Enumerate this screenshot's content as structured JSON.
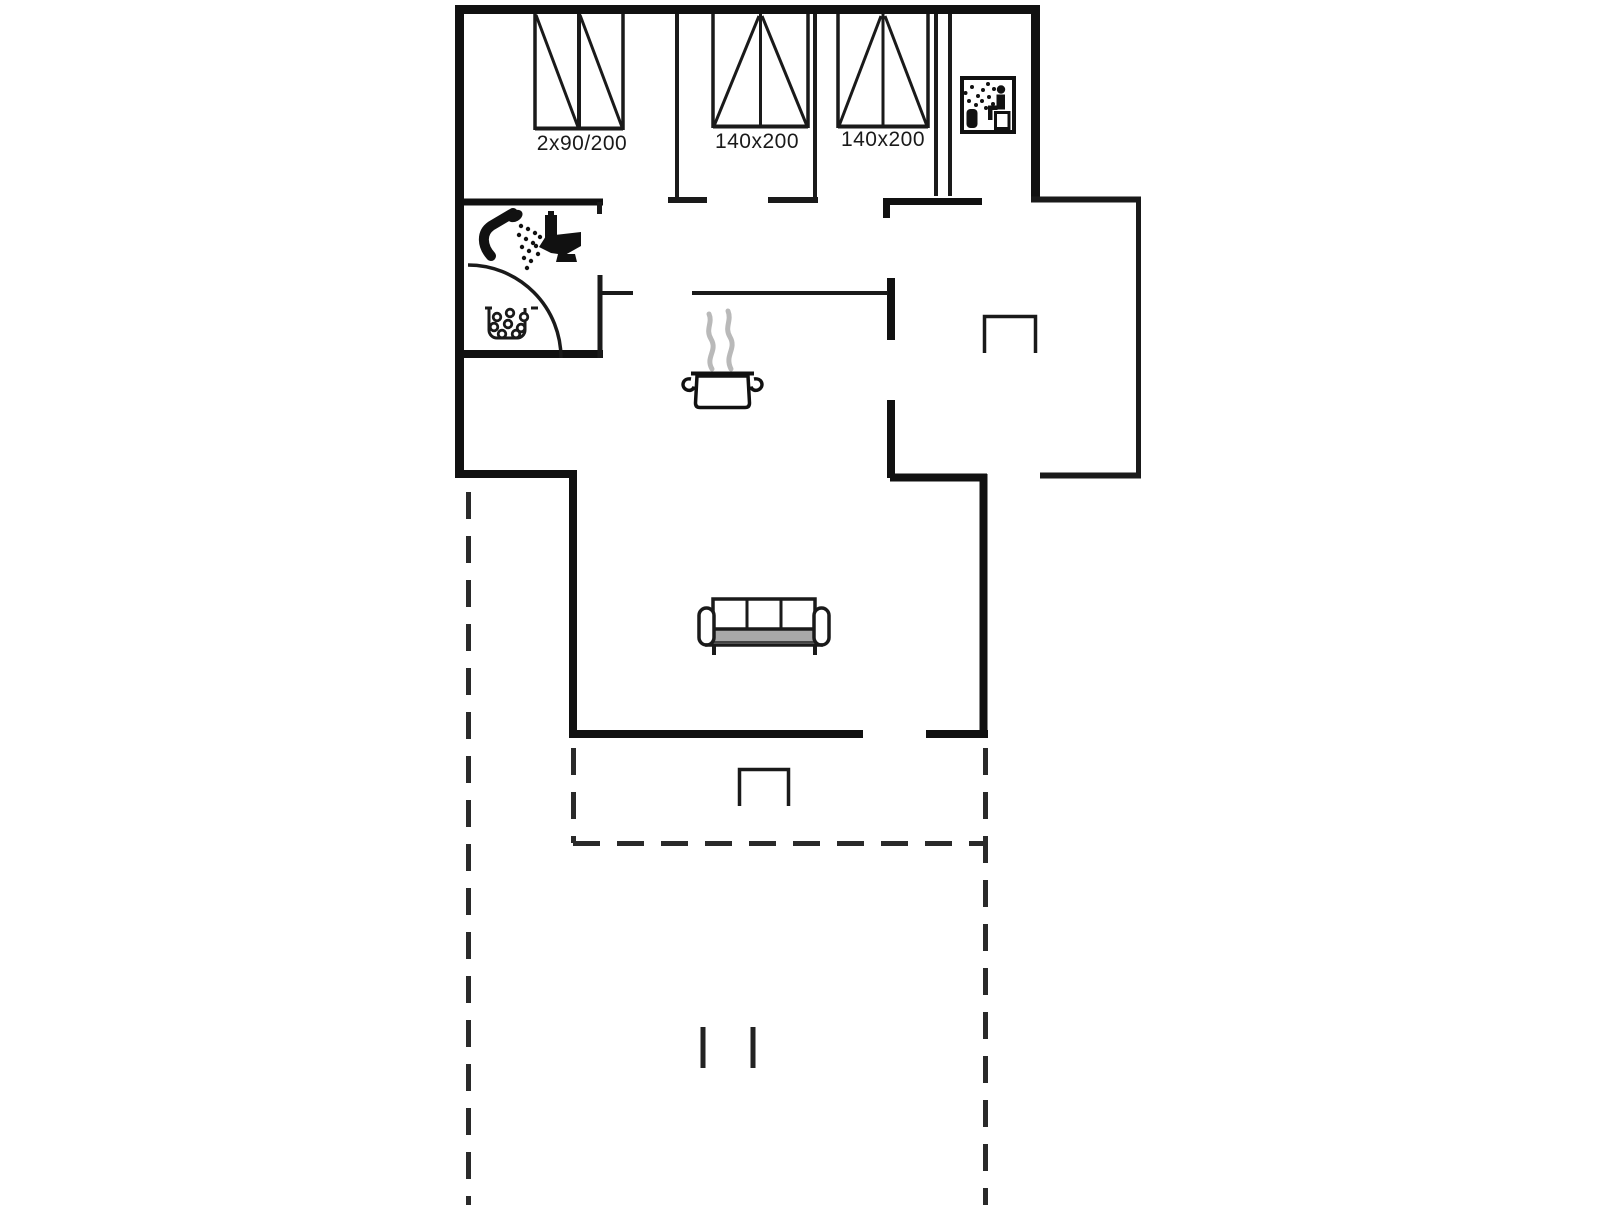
{
  "labels": {
    "bed_double": "2x90/200",
    "bed_mid": "140x200",
    "bed_right": "140x200"
  },
  "colors": {
    "ink": "#111111",
    "thin_line": "#1a1a1a",
    "dash_line": "#2a2a2a",
    "steam_gray": "#b9b9b9",
    "sofa_seat_gray": "#a8a8a8",
    "text": "#1a1a1a",
    "background": "#ffffff"
  },
  "icons": [
    {
      "name": "sauna-icon"
    },
    {
      "name": "shower-icon"
    },
    {
      "name": "toilet-icon"
    },
    {
      "name": "whirlpool-icon"
    },
    {
      "name": "cooking-pot-icon"
    },
    {
      "name": "steam-icon"
    },
    {
      "name": "sofa-icon"
    },
    {
      "name": "wood-stove-icon"
    },
    {
      "name": "terrace-dashed-outline"
    }
  ]
}
